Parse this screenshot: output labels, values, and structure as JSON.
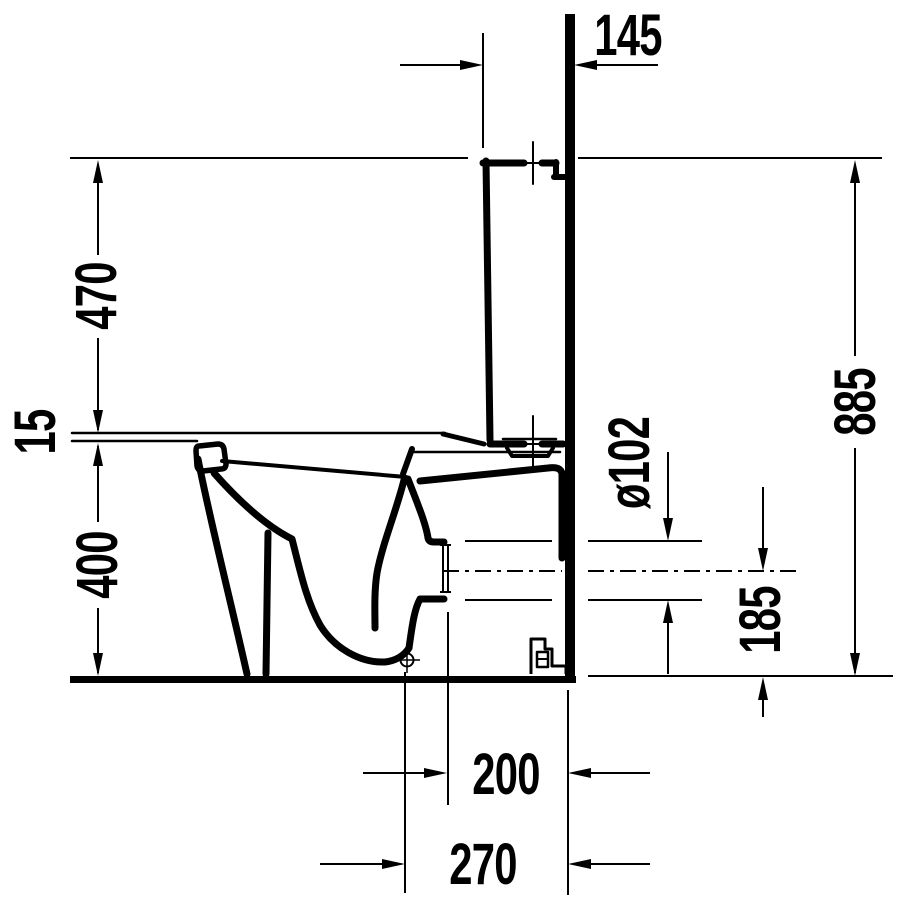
{
  "drawing": {
    "description": "Technical side-section drawing of a floor-standing close-coupled toilet with cistern against a wall, with installation dimensions in millimetres",
    "background_color": "#ffffff",
    "ink_color": "#000000",
    "labels": {
      "cistern_depth": "145",
      "cistern_height": "470",
      "seat_thickness": "15",
      "bowl_height": "400",
      "total_height": "885",
      "outlet_diameter": "ø102",
      "outlet_axis_height": "185",
      "outlet_to_wall": "200",
      "fixing_to_wall": "270"
    }
  }
}
